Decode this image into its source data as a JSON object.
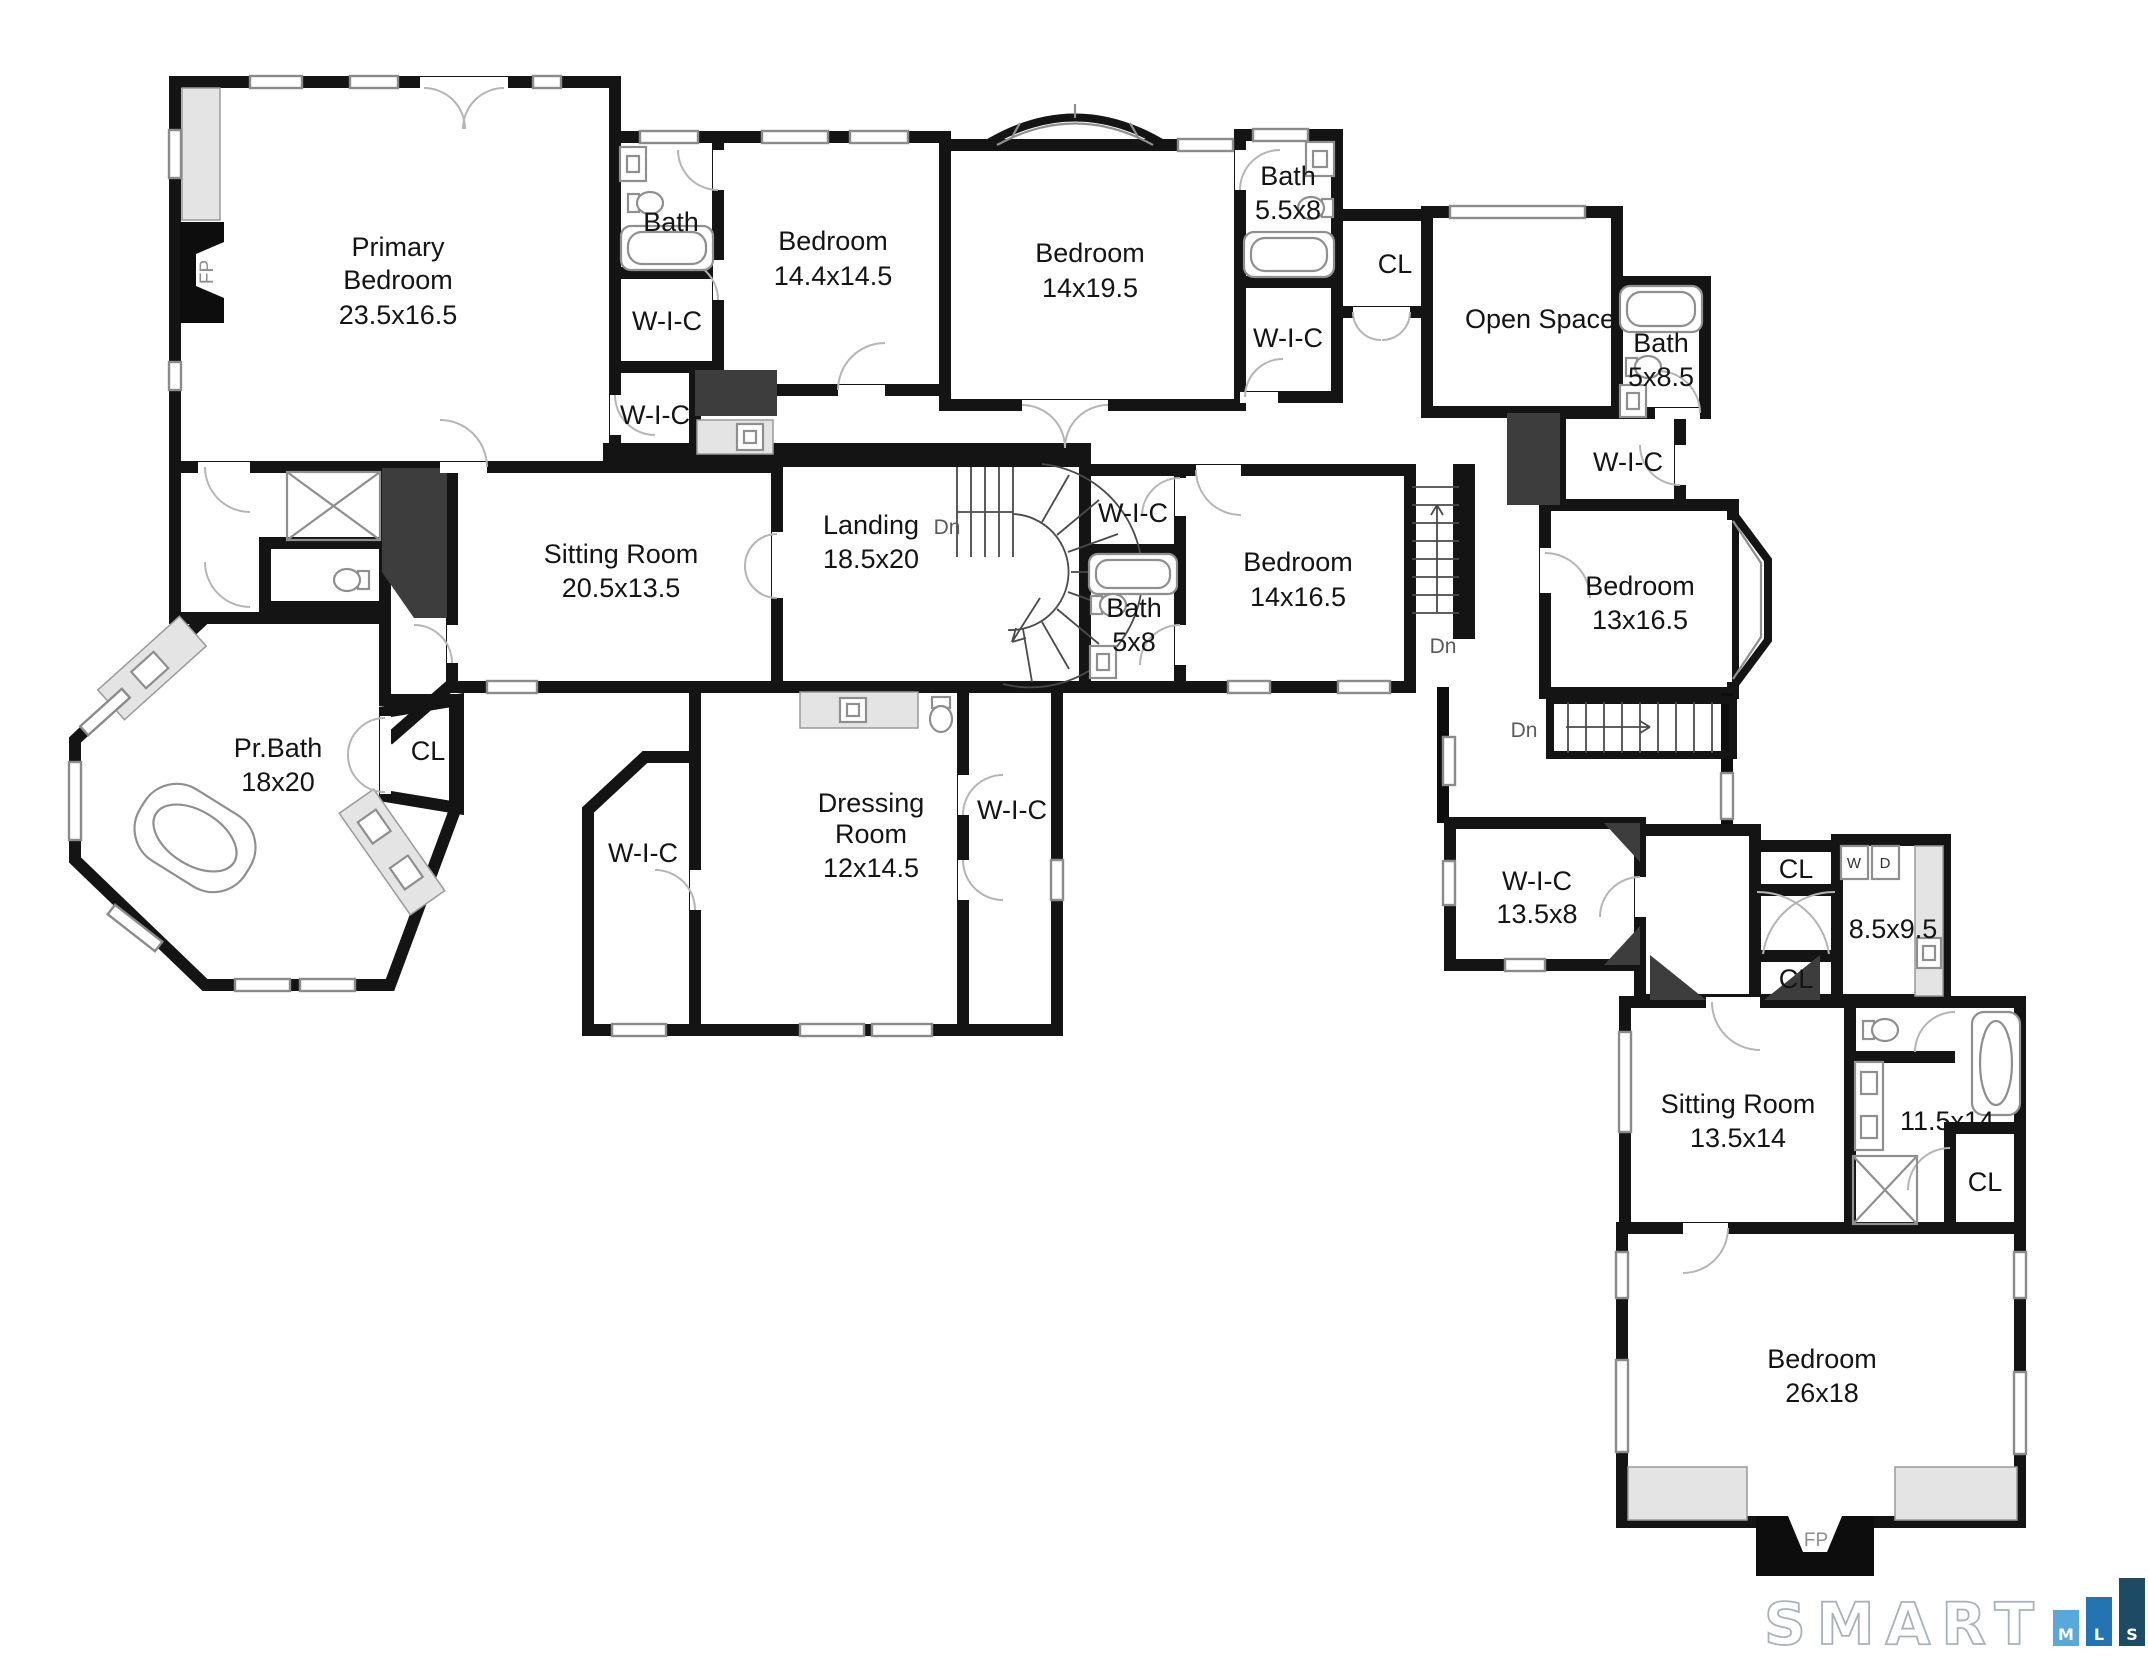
{
  "strings": {
    "wic": "W-I-C",
    "cl": "CL",
    "bath": "Bath",
    "dn": "Dn",
    "fp": "FP",
    "w": "W",
    "d": "D"
  },
  "rooms": {
    "primary_bedroom": {
      "line1": "Primary",
      "line2": "Bedroom",
      "dims": "23.5x16.5"
    },
    "bedroom_144": {
      "line1": "Bedroom",
      "dims": "14.4x14.5"
    },
    "bedroom_1419": {
      "line1": "Bedroom",
      "dims": "14x19.5"
    },
    "bath_558": {
      "line1": "Bath",
      "dims": "5.5x8"
    },
    "open_space": {
      "line1": "Open Space"
    },
    "bath_5x85": {
      "line1": "Bath",
      "dims": "5x8.5"
    },
    "sitting_room_1": {
      "line1": "Sitting Room",
      "dims": "20.5x13.5"
    },
    "landing": {
      "line1": "Landing",
      "dims": "18.5x20"
    },
    "bath_5x8": {
      "line1": "Bath",
      "dims": "5x8"
    },
    "bedroom_1416": {
      "line1": "Bedroom",
      "dims": "14x16.5"
    },
    "bedroom_1316": {
      "line1": "Bedroom",
      "dims": "13x16.5"
    },
    "pr_bath": {
      "line1": "Pr.Bath",
      "dims": "18x20"
    },
    "dressing_room": {
      "line1": "Dressing",
      "line2": "Room",
      "dims": "12x14.5"
    },
    "wic_1358": {
      "line1": "W-I-C",
      "dims": "13.5x8"
    },
    "laundry": {
      "dims": "8.5x9.5"
    },
    "sitting_room_2": {
      "line1": "Sitting Room",
      "dims": "13.5x14"
    },
    "bath_11514": {
      "dims": "11.5x14"
    },
    "bedroom_2618": {
      "line1": "Bedroom",
      "dims": "26x18"
    }
  },
  "branding": {
    "name": "SMART",
    "m": "M",
    "l": "L",
    "s": "S",
    "m_color": "#58a8da",
    "l_color": "#2473b2",
    "s_color": "#1d4b66",
    "outline_color": "#a9b2ba"
  }
}
